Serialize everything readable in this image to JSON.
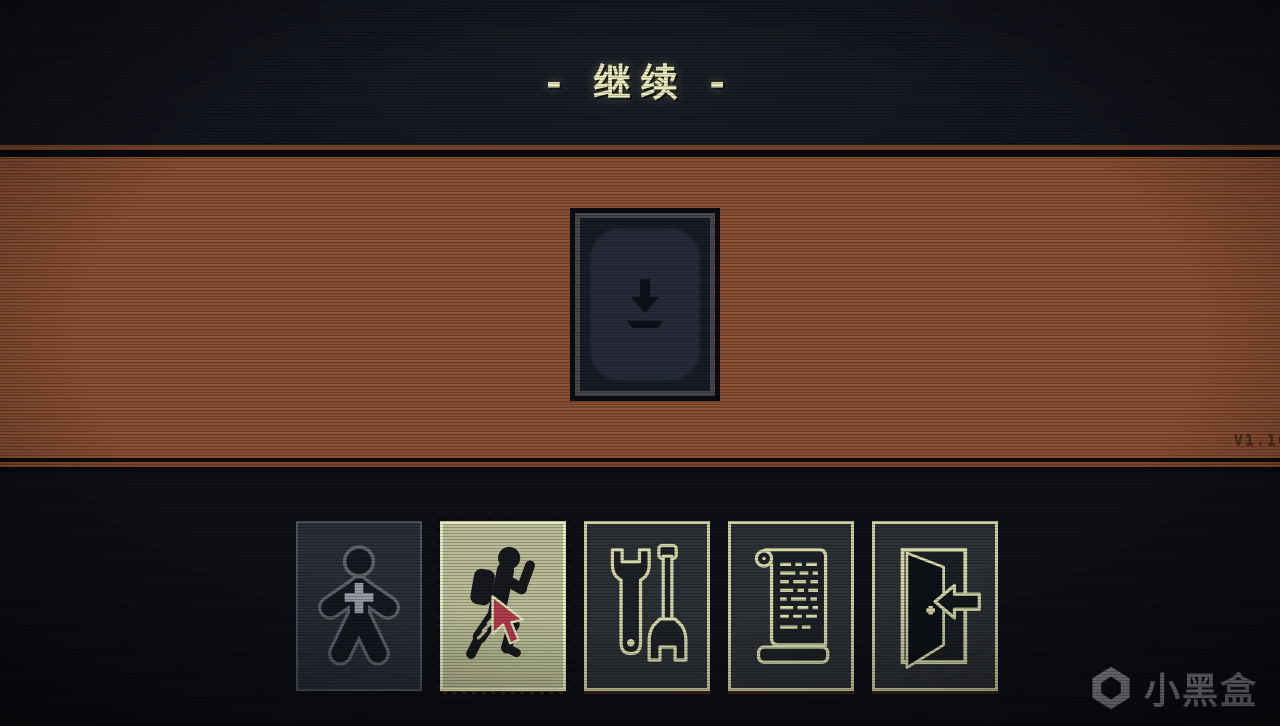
{
  "screen": {
    "width": 1280,
    "height": 726
  },
  "header": {
    "title": "- 继续 -"
  },
  "stage": {
    "version_label": "V1.10",
    "card": {
      "icon": "download-arrow-icon",
      "description": "face-down deck card with download arrow"
    }
  },
  "toolbar": {
    "buttons": [
      {
        "id": "status",
        "icon": "person-plus-icon",
        "state": "dim"
      },
      {
        "id": "continue-journey",
        "icon": "hiker-icon",
        "state": "selected",
        "cursor": "red-pointer-cursor"
      },
      {
        "id": "tools",
        "icon": "wrench-tools-icon",
        "state": "normal"
      },
      {
        "id": "log",
        "icon": "scroll-icon",
        "state": "normal"
      },
      {
        "id": "exit",
        "icon": "exit-door-icon",
        "state": "normal"
      }
    ]
  },
  "watermark": {
    "brand": "小黑盒",
    "icon": "heybox-logo-icon"
  },
  "colors": {
    "background": "#13151c",
    "band_orange": "#8c5034",
    "band_orange_dark": "#7a432a",
    "title_text": "#e9ebbd",
    "panel_highlight": "#b8bb95",
    "panel_dark": "#2d3035",
    "icon_outline": "#d6daab",
    "cursor_red": "#b43c4e",
    "card_inner": "#252b38",
    "version_text": "#4e2e1d",
    "watermark_gray": "#97999f"
  }
}
